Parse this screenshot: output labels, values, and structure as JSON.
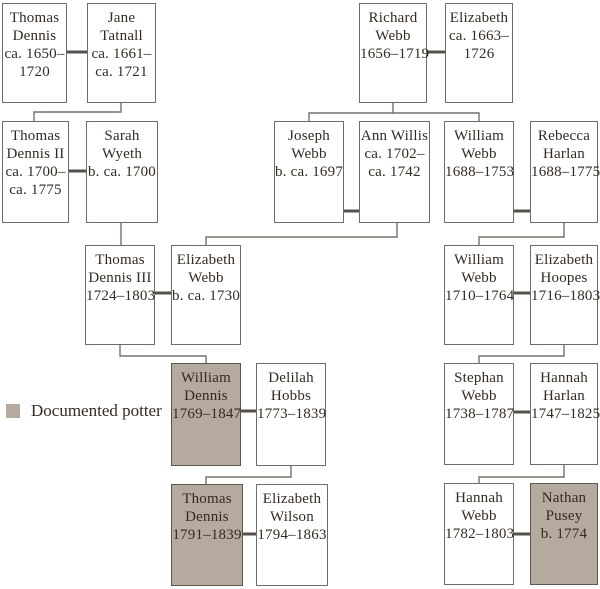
{
  "diagram_type": "family-tree",
  "legend": {
    "label": "Documented potter",
    "swatch_color": "#b4ab9e"
  },
  "colors": {
    "background": "#ffffff",
    "box_border": "#6f6b67",
    "descent_line": "#76726d",
    "spouse_line": "#55504b",
    "highlight_fill": "#b4ab9e",
    "text": "#332b22"
  },
  "people": [
    {
      "name": "Thomas Dennis",
      "dates": "ca. 1650–1720",
      "documented_potter": false,
      "lines": [
        "Thomas",
        "Dennis",
        "ca. 1650–",
        "1720"
      ]
    },
    {
      "name": "Jane Tatnall",
      "dates": "ca. 1661–ca. 1721",
      "documented_potter": false,
      "lines": [
        "Jane",
        "Tatnall",
        "ca. 1661–",
        "ca. 1721"
      ]
    },
    {
      "name": "Richard Webb",
      "dates": "1656–1719",
      "documented_potter": false,
      "lines": [
        "Richard",
        "Webb",
        "1656–1719"
      ]
    },
    {
      "name": "Elizabeth",
      "dates": "ca. 1663–1726",
      "documented_potter": false,
      "lines": [
        "Elizabeth",
        "ca. 1663–",
        "1726"
      ]
    },
    {
      "name": "Thomas Dennis II",
      "dates": "ca. 1700–ca. 1775",
      "documented_potter": false,
      "lines": [
        "Thomas",
        "Dennis II",
        "ca. 1700–",
        "ca. 1775"
      ]
    },
    {
      "name": "Sarah Wyeth",
      "dates": "b. ca. 1700",
      "documented_potter": false,
      "lines": [
        "Sarah",
        "Wyeth",
        "b. ca. 1700"
      ]
    },
    {
      "name": "Joseph Webb",
      "dates": "b. ca. 1697",
      "documented_potter": false,
      "lines": [
        "Joseph",
        "Webb",
        "b. ca. 1697"
      ]
    },
    {
      "name": "Ann Willis",
      "dates": "ca. 1702–ca. 1742",
      "documented_potter": false,
      "lines": [
        "Ann Willis",
        "ca. 1702–",
        "ca. 1742"
      ]
    },
    {
      "name": "William Webb",
      "dates": "1688–1753",
      "documented_potter": false,
      "lines": [
        "William",
        "Webb",
        "1688–1753"
      ]
    },
    {
      "name": "Rebecca Harlan",
      "dates": "1688–1775",
      "documented_potter": false,
      "lines": [
        "Rebecca",
        "Harlan",
        "1688–1775"
      ]
    },
    {
      "name": "Thomas Dennis III",
      "dates": "1724–1803",
      "documented_potter": false,
      "lines": [
        "Thomas",
        "Dennis III",
        "1724–1803"
      ]
    },
    {
      "name": "Elizabeth Webb",
      "dates": "b. ca. 1730",
      "documented_potter": false,
      "lines": [
        "Elizabeth",
        "Webb",
        "b. ca. 1730"
      ]
    },
    {
      "name": "William Webb",
      "dates": "1710–1764",
      "documented_potter": false,
      "lines": [
        "William",
        "Webb",
        "1710–1764"
      ]
    },
    {
      "name": "Elizabeth Hoopes",
      "dates": "1716–1803",
      "documented_potter": false,
      "lines": [
        "Elizabeth",
        "Hoopes",
        "1716–1803"
      ]
    },
    {
      "name": "William Dennis",
      "dates": "1769–1847",
      "documented_potter": true,
      "lines": [
        "William",
        "Dennis",
        "1769–1847"
      ]
    },
    {
      "name": "Delilah Hobbs",
      "dates": "1773–1839",
      "documented_potter": false,
      "lines": [
        "Delilah",
        "Hobbs",
        "1773–1839"
      ]
    },
    {
      "name": "Stephan Webb",
      "dates": "1738–1787",
      "documented_potter": false,
      "lines": [
        "Stephan",
        "Webb",
        "1738–1787"
      ]
    },
    {
      "name": "Hannah Harlan",
      "dates": "1747–1825",
      "documented_potter": false,
      "lines": [
        "Hannah",
        "Harlan",
        "1747–1825"
      ]
    },
    {
      "name": "Thomas Dennis",
      "dates": "1791–1839",
      "documented_potter": true,
      "lines": [
        "Thomas",
        "Dennis",
        "1791–1839"
      ]
    },
    {
      "name": "Elizabeth Wilson",
      "dates": "1794–1863",
      "documented_potter": false,
      "lines": [
        "Elizabeth",
        "Wilson",
        "1794–1863"
      ]
    },
    {
      "name": "Hannah Webb",
      "dates": "1782–1803",
      "documented_potter": false,
      "lines": [
        "Hannah",
        "Webb",
        "1782–1803"
      ]
    },
    {
      "name": "Nathan Pusey",
      "dates": "b. 1774",
      "documented_potter": true,
      "lines": [
        "Nathan",
        "Pusey",
        "b. 1774"
      ]
    }
  ]
}
